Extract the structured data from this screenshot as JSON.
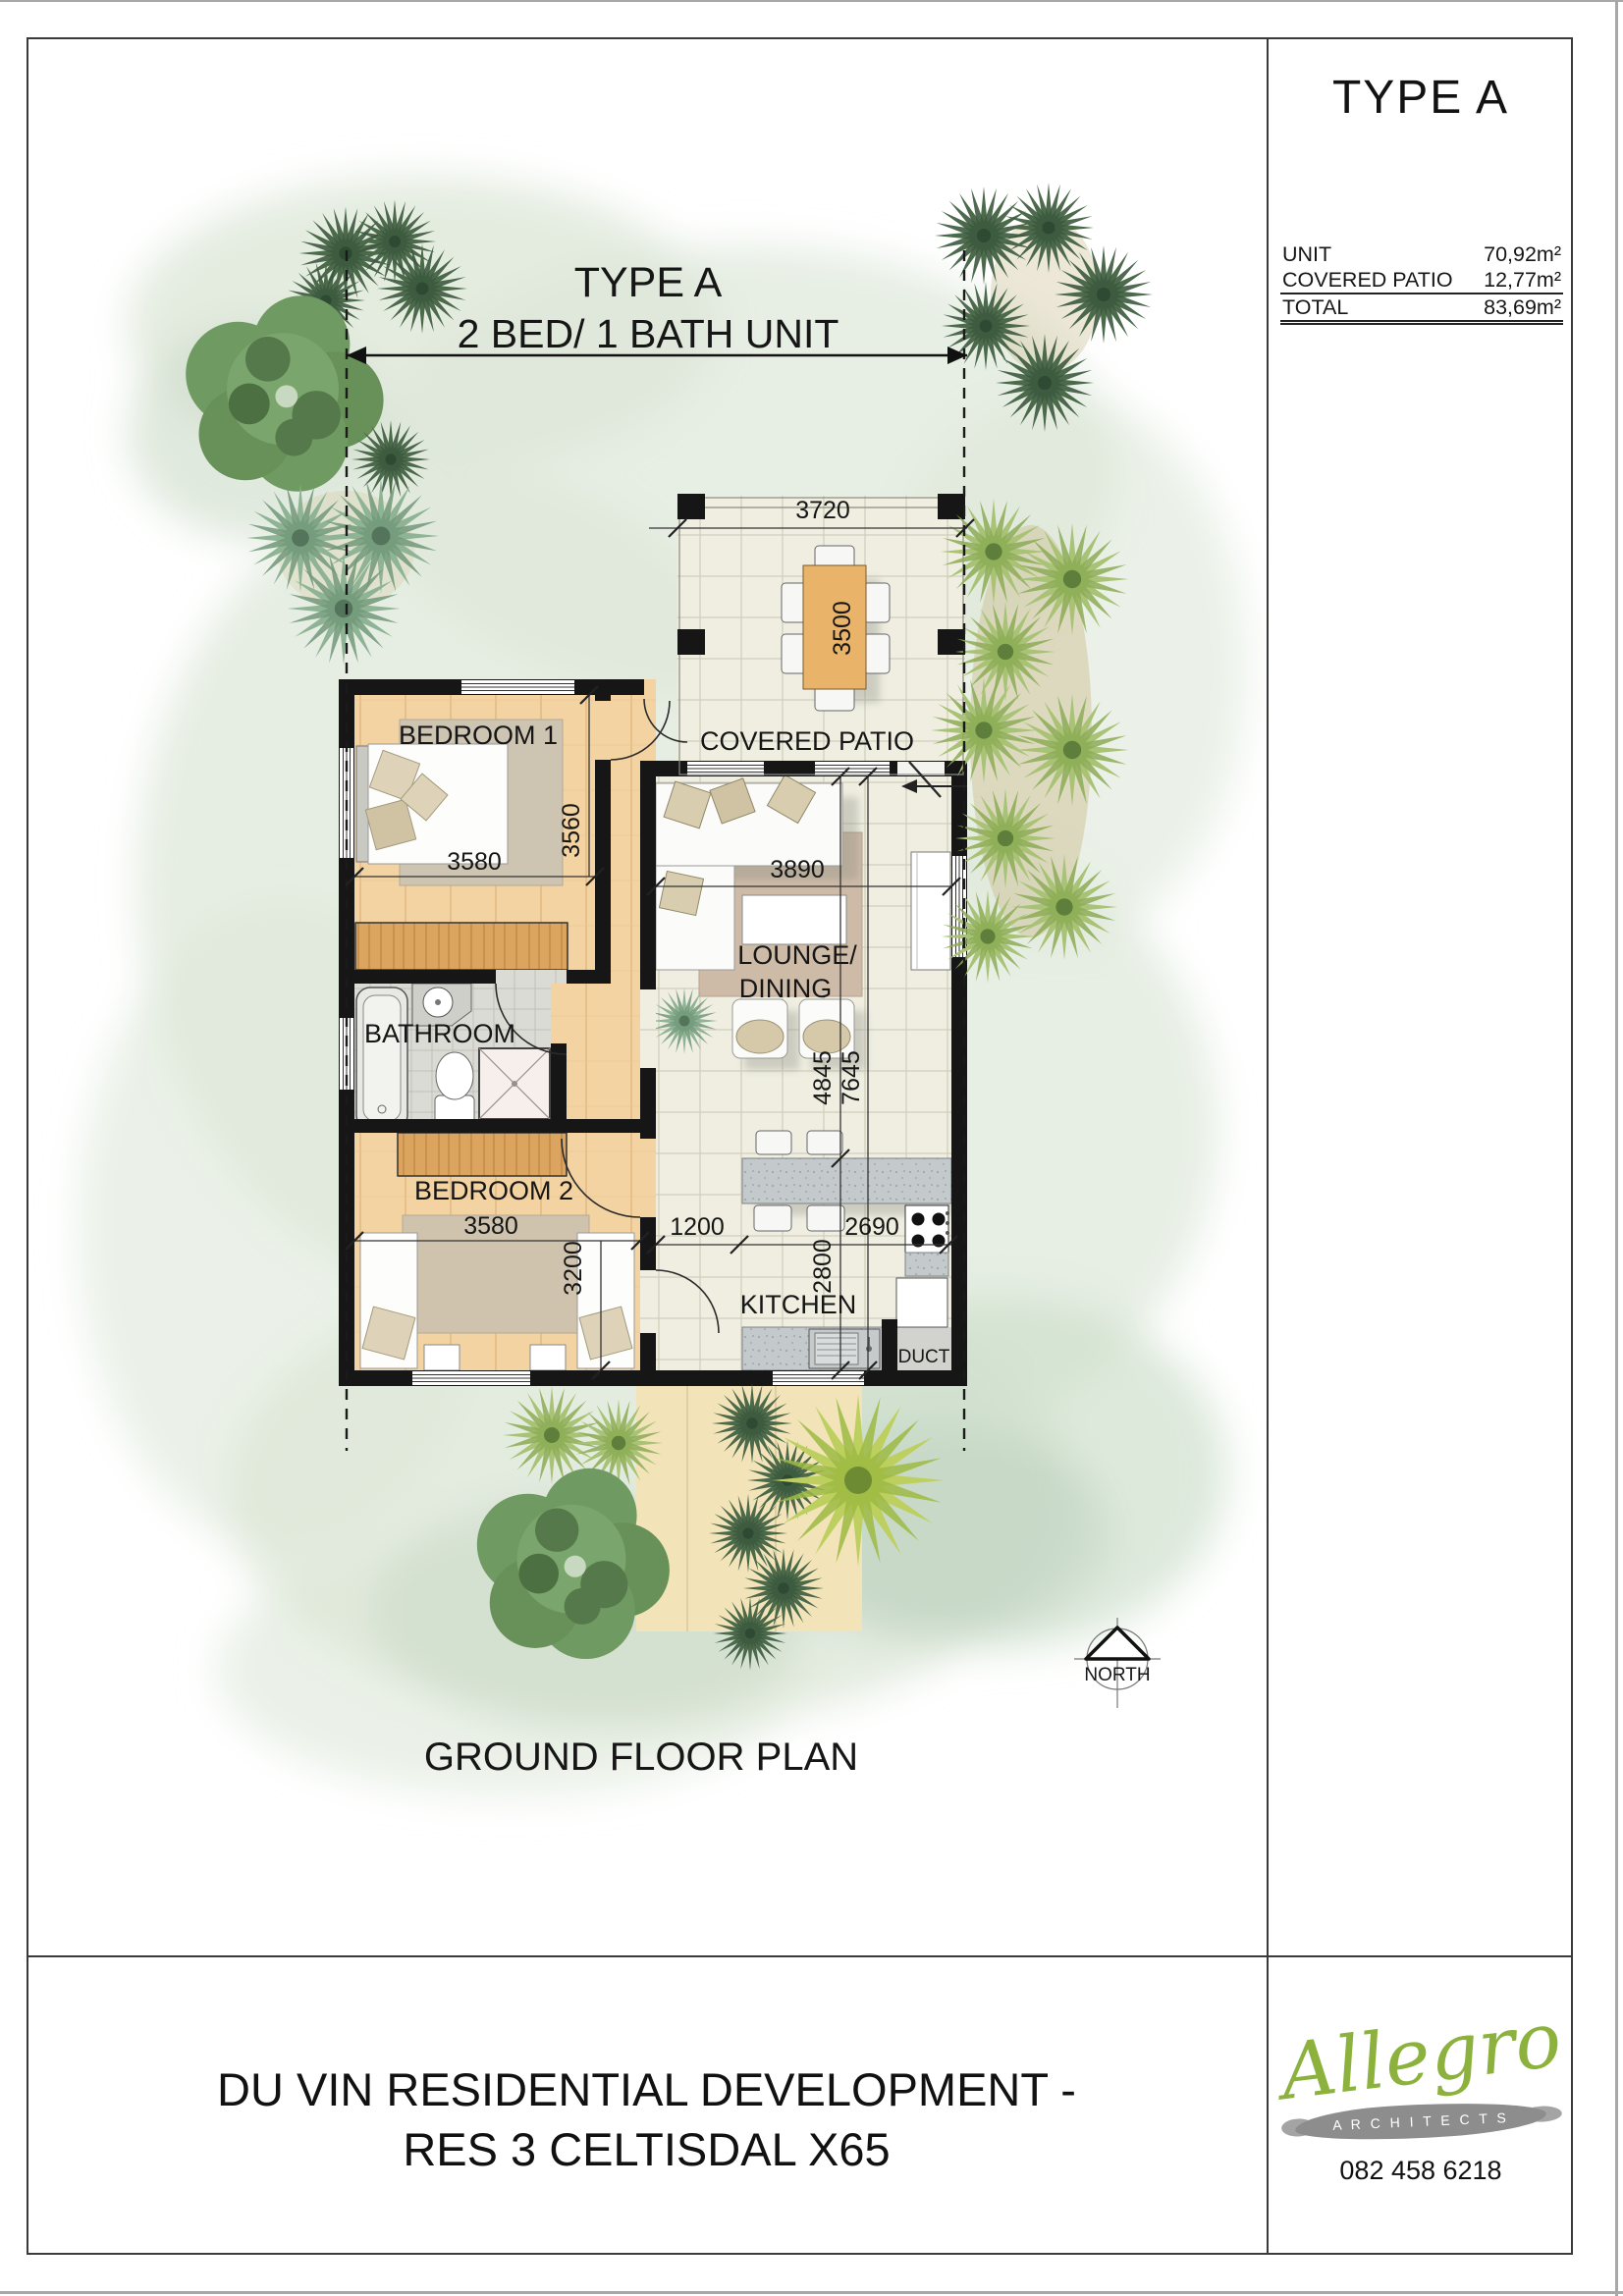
{
  "page": {
    "title_block": {
      "title": "TYPE A",
      "rows": [
        {
          "label": "UNIT",
          "value": "70,92m²"
        },
        {
          "label": "COVERED PATIO",
          "value": "12,77m²"
        },
        {
          "label": "TOTAL",
          "value": "83,69m²"
        }
      ]
    },
    "header": {
      "type": "TYPE A",
      "unit_desc": "2 BED/ 1 BATH UNIT"
    },
    "caption": "GROUND FLOOR PLAN",
    "footer": {
      "line1": "DU VIN RESIDENTIAL DEVELOPMENT -",
      "line2": "RES 3 CELTISDAL X65"
    },
    "logo": {
      "name": "Allegro",
      "subtitle": "A R C H I T E C T S",
      "phone": "082 458 6218"
    }
  },
  "plan": {
    "rooms": {
      "bedroom1": "BEDROOM 1",
      "covered_patio": "COVERED PATIO",
      "lounge_line1": "LOUNGE/",
      "lounge_line2": "DINING",
      "bathroom": "BATHROOM",
      "bedroom2": "BEDROOM 2",
      "kitchen": "KITCHEN",
      "duct": "DUCT"
    },
    "north": "NORTH",
    "dims": {
      "patio_w": "3720",
      "patio_d": "3500",
      "bed1_w": "3580",
      "bed1_d": "3560",
      "lounge_w": "3890",
      "lounge_d": "4845",
      "total_d": "7645",
      "bed2_w": "3580",
      "bed2_d": "3200",
      "passage": "1200",
      "kitchen_w": "2690",
      "kitchen_d": "2800"
    }
  },
  "colors": {
    "logo_green": "#8cb23d",
    "wall": "#161616",
    "wash": "#dde7d8"
  }
}
